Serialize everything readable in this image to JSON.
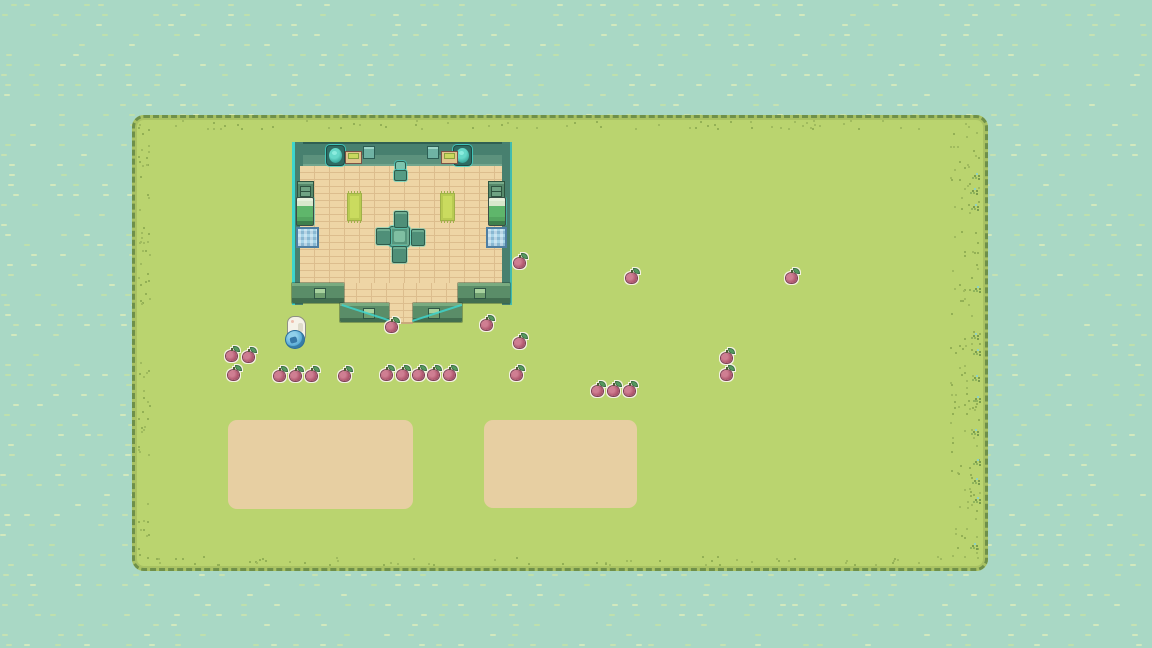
{
  "scene": {
    "name": "top-down pixel world",
    "background_color": "#a9d8c5",
    "field_color": "#bad46f",
    "field_border_color": "#6f9049",
    "highlight_color": "#3ed4cb",
    "floor_color": "#eed5a5",
    "wall_color": "#5a8d68",
    "dirt_color": "#e7cfa2",
    "apple_color": "#b25970"
  },
  "entities": {
    "player": {
      "x": 285,
      "y": 316
    },
    "npc": {
      "x": 393,
      "y": 161
    },
    "apples": [
      {
        "x": 520,
        "y": 263
      },
      {
        "x": 632,
        "y": 278
      },
      {
        "x": 792,
        "y": 278
      },
      {
        "x": 392,
        "y": 327
      },
      {
        "x": 487,
        "y": 325
      },
      {
        "x": 520,
        "y": 343
      },
      {
        "x": 727,
        "y": 358
      },
      {
        "x": 232,
        "y": 356
      },
      {
        "x": 249,
        "y": 357
      },
      {
        "x": 234,
        "y": 375
      },
      {
        "x": 280,
        "y": 376
      },
      {
        "x": 296,
        "y": 376
      },
      {
        "x": 312,
        "y": 376
      },
      {
        "x": 345,
        "y": 376
      },
      {
        "x": 387,
        "y": 375
      },
      {
        "x": 403,
        "y": 375
      },
      {
        "x": 419,
        "y": 375
      },
      {
        "x": 434,
        "y": 375
      },
      {
        "x": 450,
        "y": 375
      },
      {
        "x": 517,
        "y": 375
      },
      {
        "x": 727,
        "y": 375
      },
      {
        "x": 598,
        "y": 391
      },
      {
        "x": 614,
        "y": 391
      },
      {
        "x": 630,
        "y": 391
      }
    ],
    "dirt_patches": [
      {
        "x": 228,
        "y": 420,
        "w": 185,
        "h": 89
      },
      {
        "x": 484,
        "y": 420,
        "w": 153,
        "h": 88
      }
    ],
    "grass_tufts": [
      {
        "x": 974,
        "y": 175
      },
      {
        "x": 972,
        "y": 190
      },
      {
        "x": 973,
        "y": 206
      },
      {
        "x": 975,
        "y": 288
      },
      {
        "x": 973,
        "y": 335
      },
      {
        "x": 975,
        "y": 351
      },
      {
        "x": 974,
        "y": 377
      },
      {
        "x": 975,
        "y": 398
      },
      {
        "x": 973,
        "y": 431
      },
      {
        "x": 975,
        "y": 461
      },
      {
        "x": 974,
        "y": 480
      },
      {
        "x": 975,
        "y": 499
      },
      {
        "x": 972,
        "y": 545
      }
    ],
    "furniture": [
      {
        "type": "plant-pot",
        "x": 327,
        "y": 146,
        "w": 17,
        "h": 19
      },
      {
        "type": "plant-pot",
        "x": 454,
        "y": 146,
        "w": 17,
        "h": 19
      },
      {
        "type": "tray-table",
        "x": 345,
        "y": 151,
        "w": 15,
        "h": 11
      },
      {
        "type": "tray-table",
        "x": 441,
        "y": 151,
        "w": 15,
        "h": 11
      },
      {
        "type": "wall-box",
        "x": 363,
        "y": 146,
        "w": 10,
        "h": 11
      },
      {
        "type": "wall-box",
        "x": 427,
        "y": 146,
        "w": 10,
        "h": 11
      },
      {
        "type": "dresser",
        "x": 297,
        "y": 181,
        "w": 15,
        "h": 16
      },
      {
        "type": "dresser",
        "x": 488,
        "y": 181,
        "w": 15,
        "h": 16
      },
      {
        "type": "bed",
        "x": 296,
        "y": 197,
        "w": 16,
        "h": 27
      },
      {
        "type": "bed",
        "x": 488,
        "y": 197,
        "w": 16,
        "h": 27
      },
      {
        "type": "rug",
        "x": 347,
        "y": 193,
        "w": 13,
        "h": 26
      },
      {
        "type": "rug",
        "x": 440,
        "y": 193,
        "w": 13,
        "h": 26
      },
      {
        "type": "blue-mat",
        "x": 296,
        "y": 227,
        "w": 19,
        "h": 17
      },
      {
        "type": "blue-mat",
        "x": 486,
        "y": 227,
        "w": 17,
        "h": 17
      },
      {
        "type": "table",
        "x": 389,
        "y": 226,
        "w": 19,
        "h": 19
      },
      {
        "type": "chair",
        "x": 394,
        "y": 211,
        "w": 12,
        "h": 15
      },
      {
        "type": "chair",
        "x": 376,
        "y": 228,
        "w": 13,
        "h": 15
      },
      {
        "type": "chair",
        "x": 411,
        "y": 229,
        "w": 12,
        "h": 15
      },
      {
        "type": "chair",
        "x": 392,
        "y": 246,
        "w": 13,
        "h": 15
      }
    ]
  }
}
